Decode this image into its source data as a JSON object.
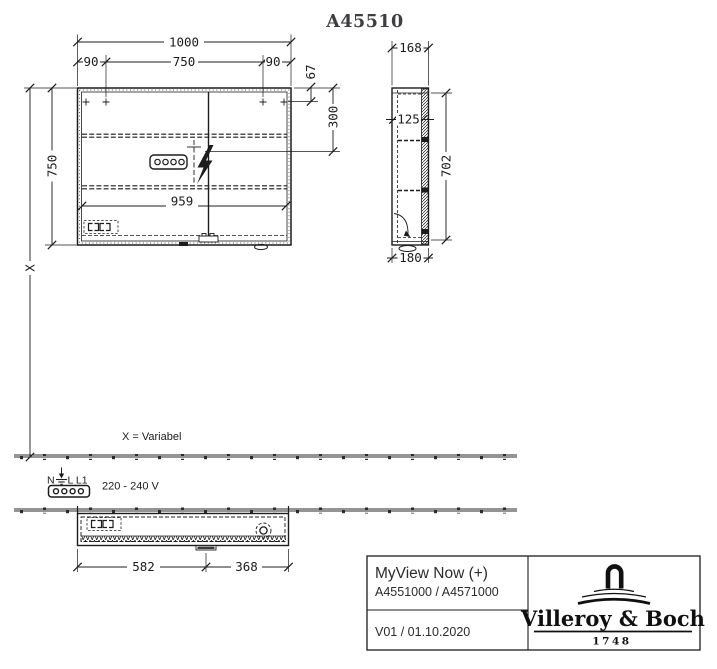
{
  "meta": {
    "background_color": "#ffffff",
    "line_color": "#1c1c1c"
  },
  "header": {
    "article_number": "A45510"
  },
  "dims": {
    "front": {
      "total_width": "1000",
      "left_offset": "90",
      "door_span": "750",
      "right_offset": "90",
      "top_to_hinge": "67",
      "top_to_socket": "300",
      "height": "750",
      "inner_width": "959",
      "to_floor": "X"
    },
    "side": {
      "depth": "168",
      "inner_depth": "125",
      "inner_height": "702",
      "total_depth": "180"
    },
    "bottom_view": {
      "left_section": "582",
      "right_section": "368"
    }
  },
  "annotations": {
    "variable_note": "X = Variabel",
    "electrical": {
      "terminal_n": "N",
      "terminal_l": "L L1",
      "voltage": "220 - 240 V"
    }
  },
  "title_block": {
    "product_name": "MyView Now (+)",
    "article_numbers": "A4551000 / A4571000",
    "version_date": "V01 / 01.10.2020",
    "brand_name": "Villeroy & Boch",
    "brand_year": "1748"
  },
  "icons": {
    "lightning": "power-connection",
    "socket": "built-in-socket",
    "ground": "earth-terminal",
    "connector": "4-pin-plug",
    "wall": "wall-section-hatch"
  }
}
